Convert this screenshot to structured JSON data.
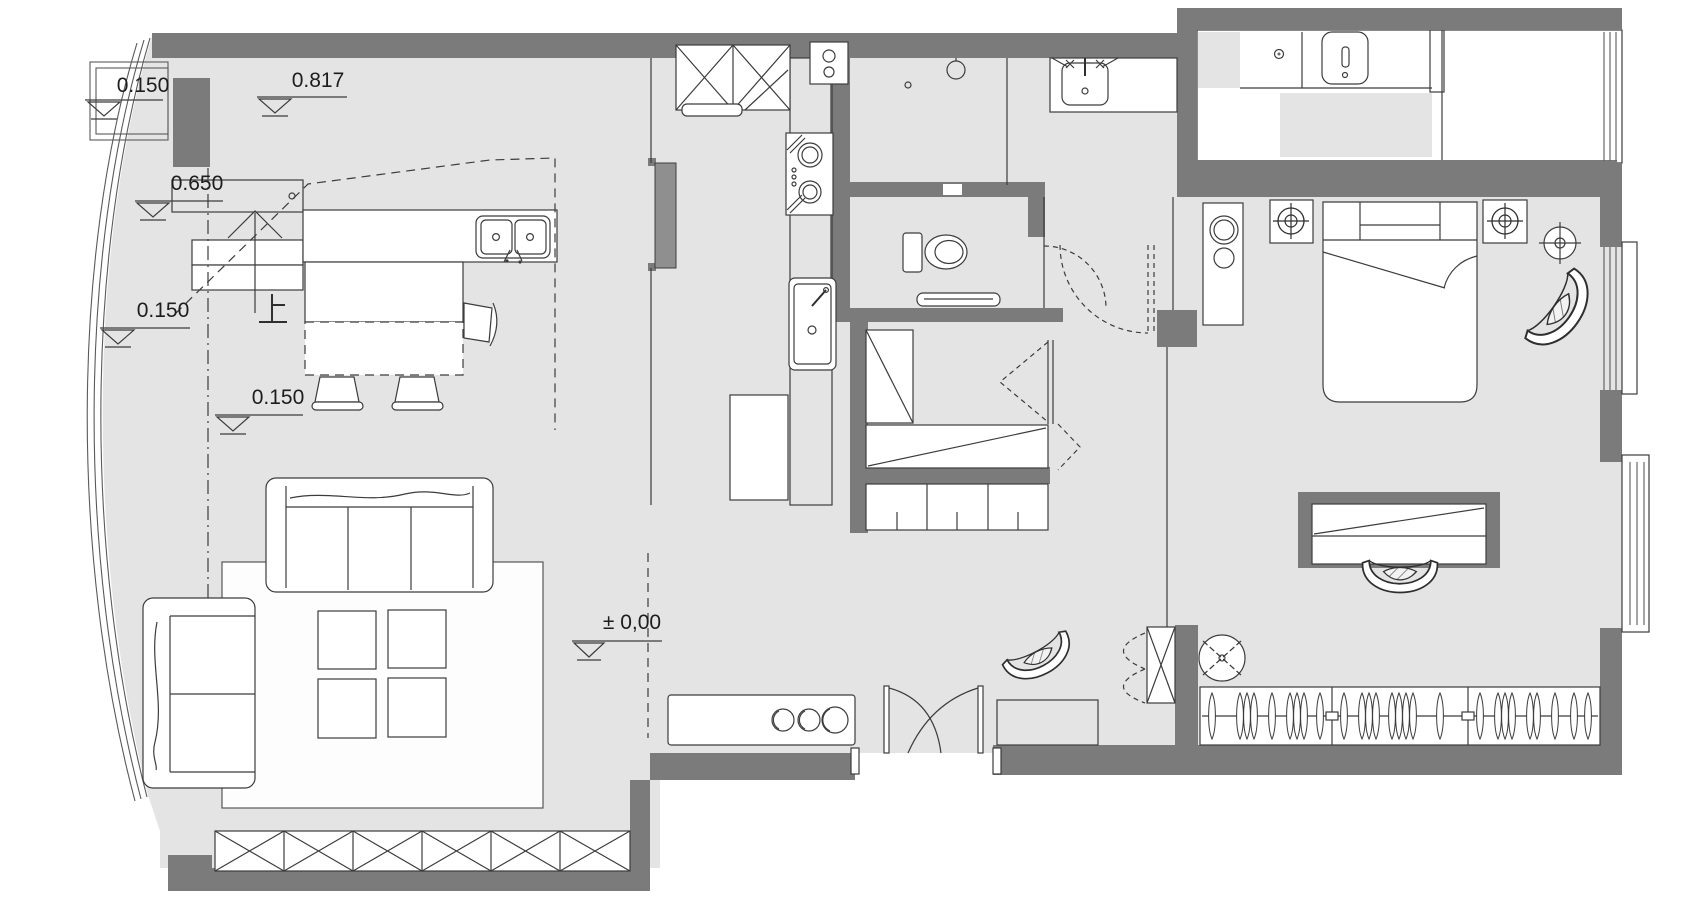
{
  "title": "apartment-floor-plan",
  "annotations": {
    "level_entry_porch": "0.150",
    "level_entry_landing": "0.817",
    "level_stair_mid": "0.650",
    "level_left_walkway": "0.150",
    "level_dining": "0.150",
    "level_main_floor": "± 0,00",
    "stair_direction": "上"
  },
  "colors": {
    "wall": "#7b7b7b",
    "door_panel": "#8f8f8f",
    "floor": "#e4e4e5",
    "line": "#3c3c3c",
    "furniture_fill": "#ffffff",
    "canvas": "#ffffff"
  },
  "symbols": [
    "level-marker",
    "stair-up-arrow",
    "dining-table",
    "dining-chair",
    "kitchen-island-double-sink",
    "refrigerator-x-cabinet",
    "gas-stove",
    "kitchen-sink",
    "sliding-door-panel",
    "shower-head",
    "washbasin-vanity",
    "toilet",
    "towel-bar",
    "pocket-door",
    "bifold-door",
    "washing-machine",
    "floor-drain",
    "vent-duct",
    "bed",
    "pillow-headboard",
    "nightstand-lamp",
    "floor-lamp",
    "ac-cabinet",
    "armchair",
    "desk-niche",
    "tub-chair",
    "coat-stand",
    "wardrobe-hangers",
    "sofa-3-seat",
    "sofa-2-seat",
    "coffee-table",
    "tv-console",
    "storage-x-cabinets",
    "entry-double-door",
    "shoe-bench-hatched",
    "shoe-x-cabinet",
    "bay-window",
    "curved-window-wall"
  ]
}
